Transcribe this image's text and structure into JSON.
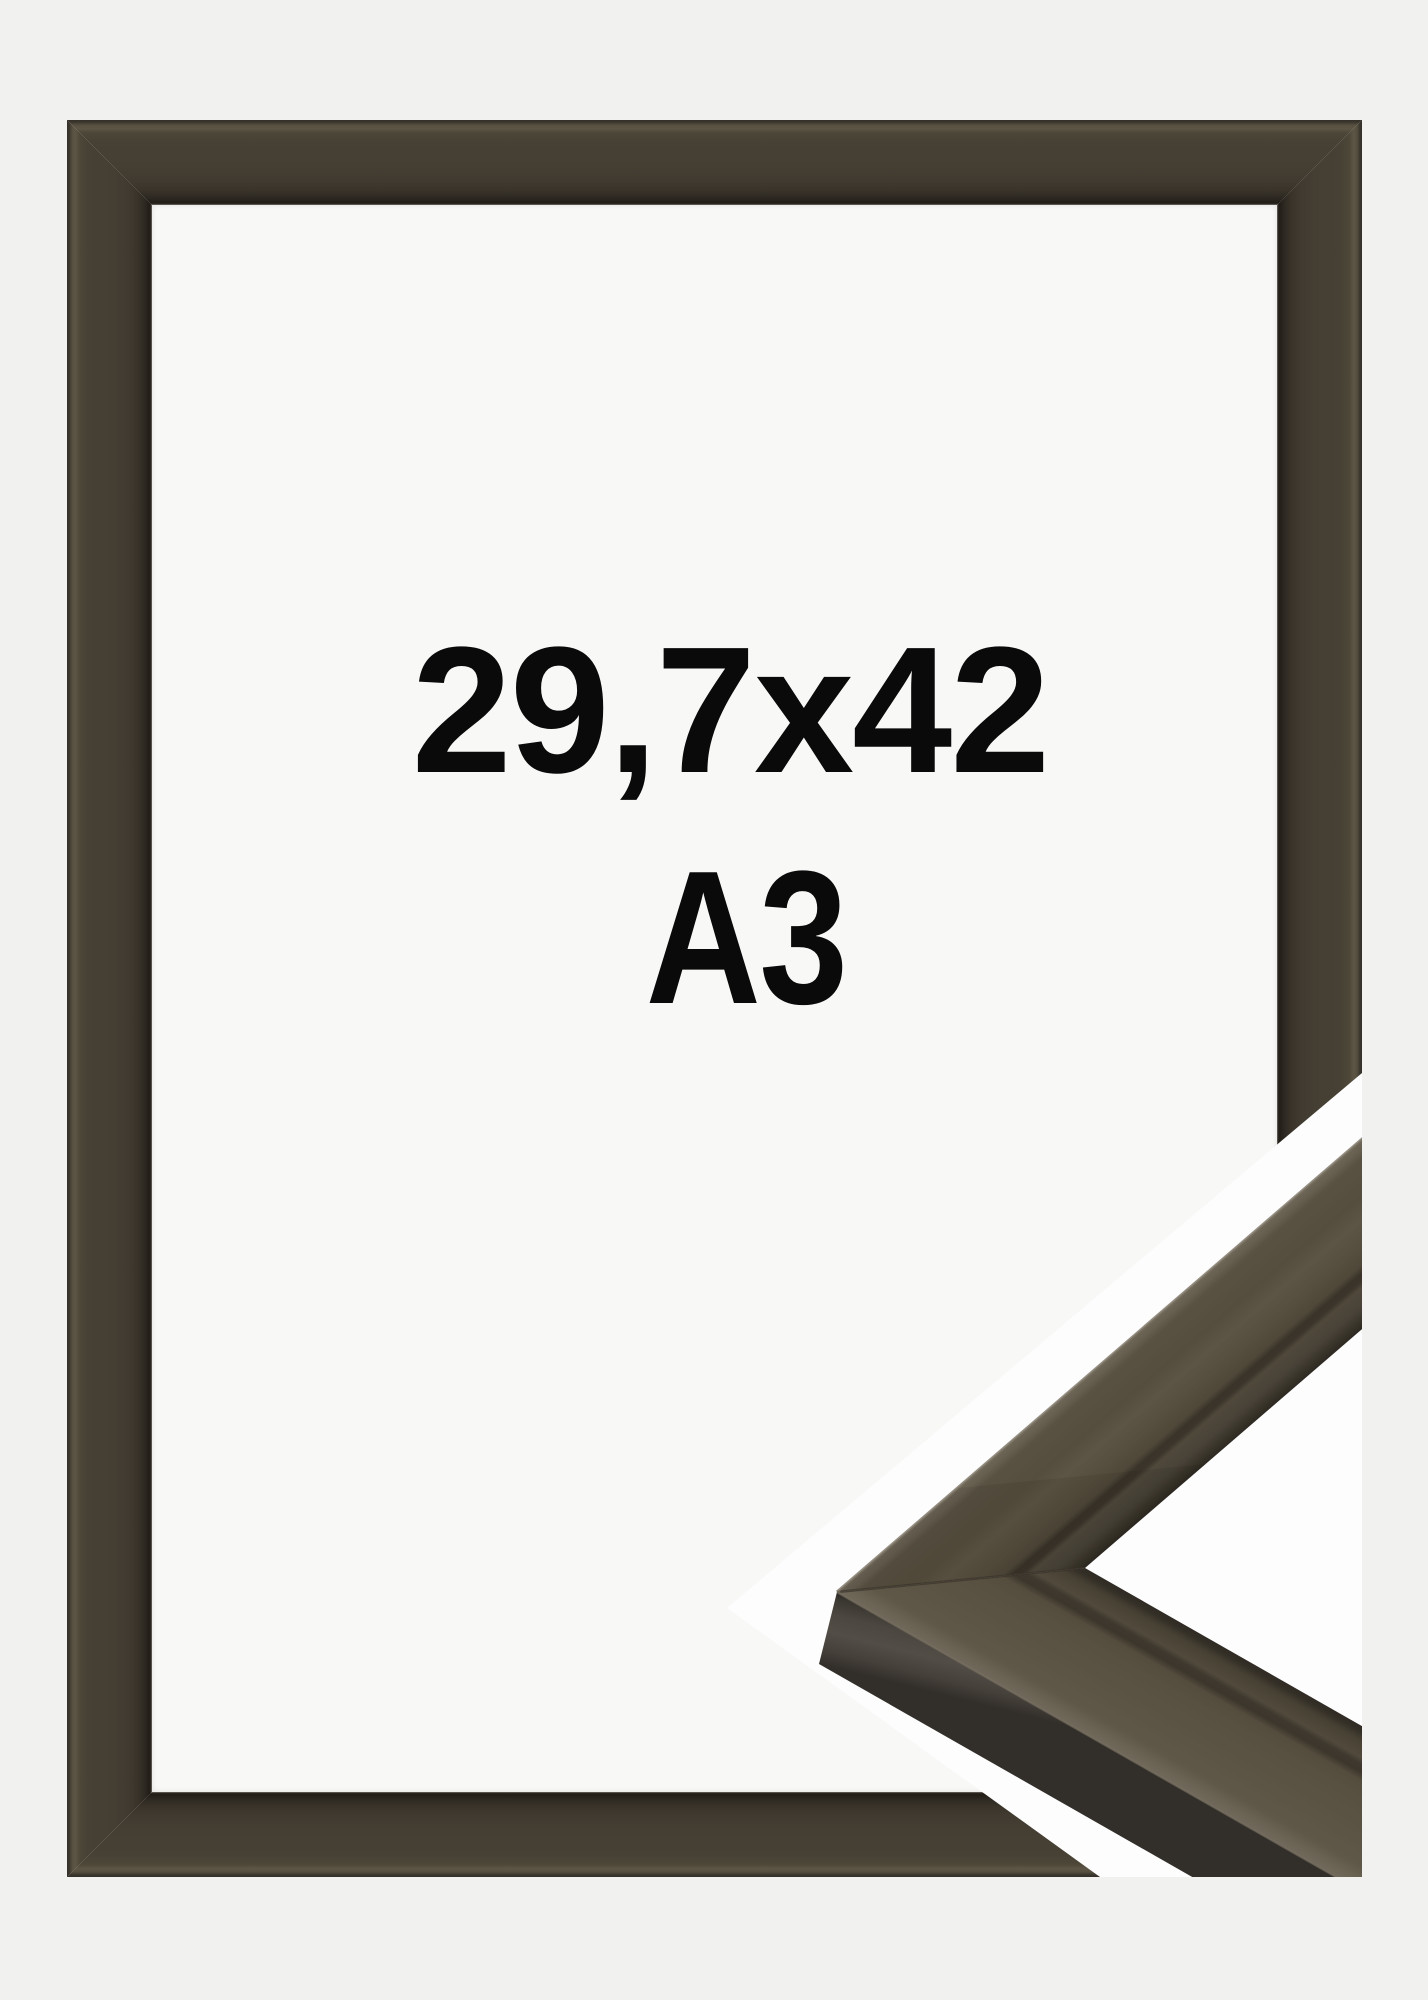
{
  "product_image": {
    "size_label": "29,7x42",
    "format_label": "A3",
    "description": "picture frame product photo with corner profile close-up inset",
    "frame_color_name": "brown",
    "colors": {
      "page_background": "#f1f1f0",
      "frame_face": "#453f35",
      "frame_highlight": "#5d5545",
      "frame_dark_edge": "#211d17",
      "frame_inner_lip": "#5a564f",
      "interior_background": "#f8f8f7",
      "inset_background": "#fdfdfd",
      "sample_face": "#564e3e",
      "sample_bevel_highlight": "#6e6657",
      "sample_groove": "#393329",
      "sample_side_face": "#4b4641",
      "text": "#0a0a0a"
    }
  }
}
